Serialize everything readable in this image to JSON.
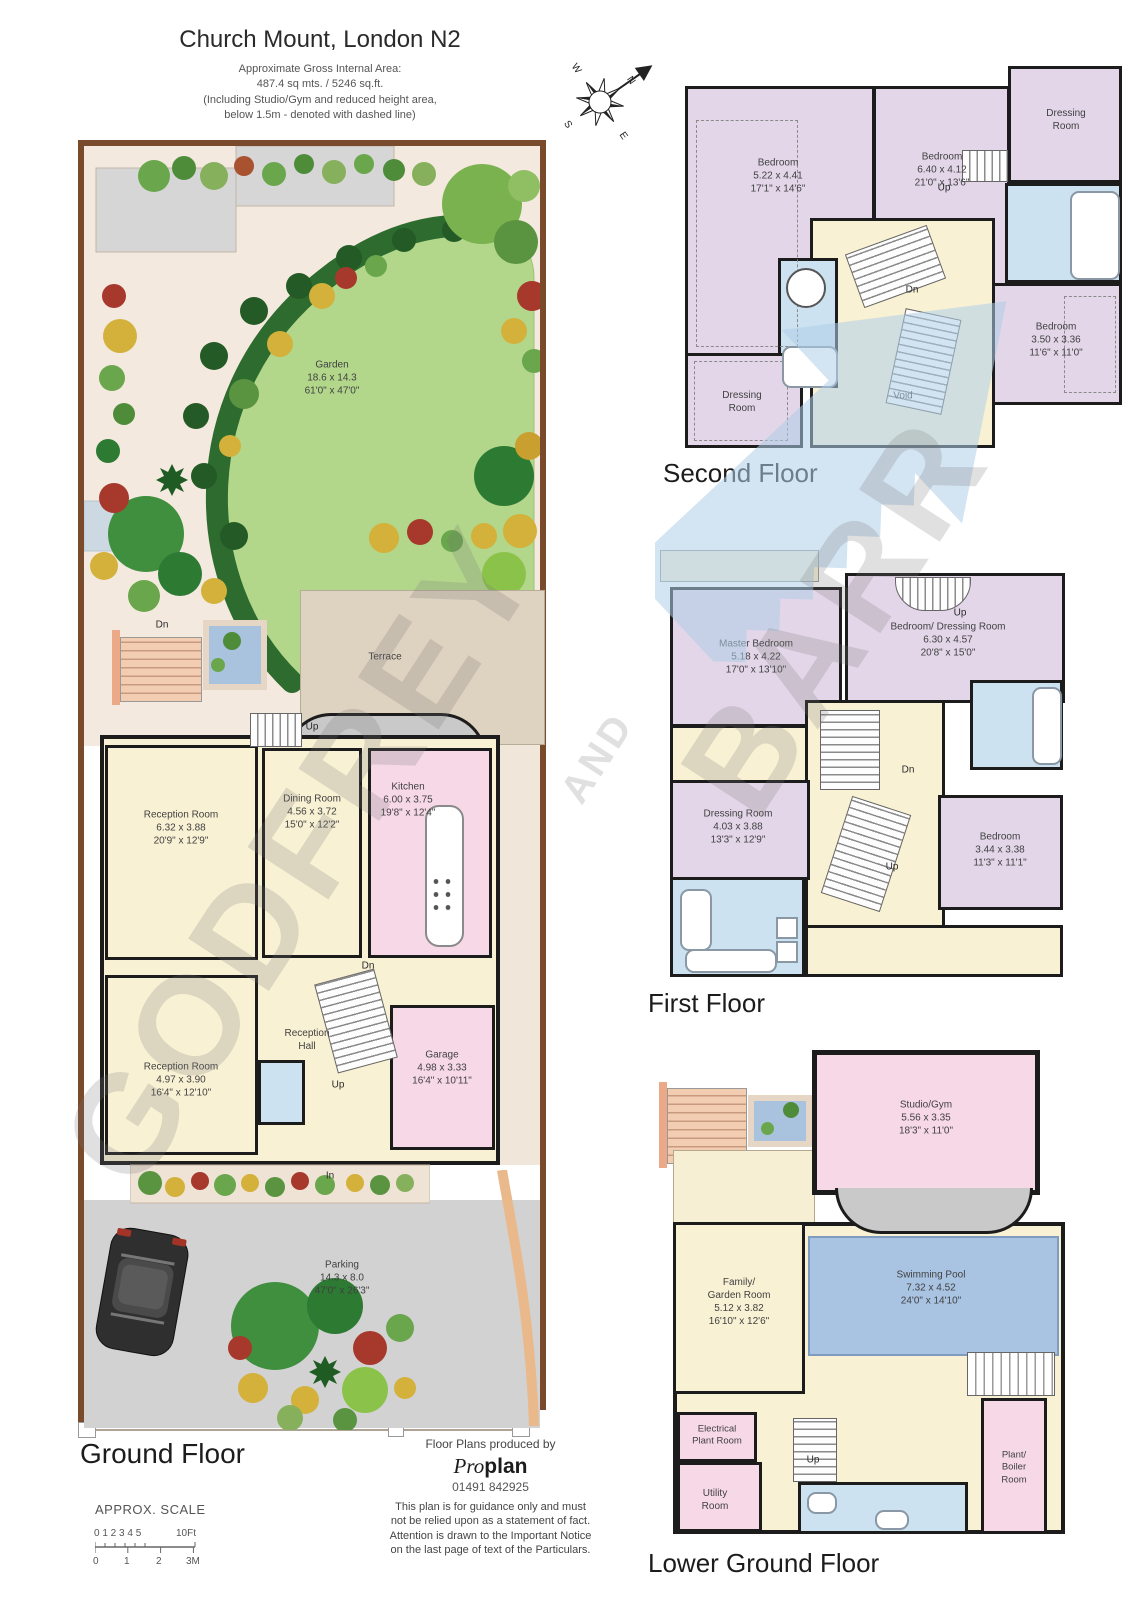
{
  "header": {
    "title": "Church Mount, London N2",
    "subtitle_lines": [
      "Approximate Gross Internal Area:",
      "487.4 sq mts. / 5246 sq.ft.",
      "(Including Studio/Gym and reduced height area,",
      "below 1.5m - denoted with dashed line)"
    ]
  },
  "compass": {
    "n": "N",
    "e": "E",
    "s": "S",
    "w": "W"
  },
  "ann": {
    "up": "Up",
    "dn": "Dn",
    "in": "In"
  },
  "watermark": {
    "word1": "GODFREY",
    "word2": "AND",
    "word3": "BARR"
  },
  "floors": {
    "ground": {
      "label": "Ground Floor",
      "garden": {
        "lines": [
          "Garden",
          "18.6 x 14.3",
          "61'0\" x 47'0\""
        ]
      },
      "terrace": {
        "lines": [
          "Terrace"
        ]
      },
      "reception1": {
        "lines": [
          "Reception Room",
          "6.32 x 3.88",
          "20'9\" x 12'9\""
        ]
      },
      "dining": {
        "lines": [
          "Dining Room",
          "4.56 x 3.72",
          "15'0\" x 12'2\""
        ]
      },
      "kitchen": {
        "lines": [
          "Kitchen",
          "6.00 x 3.75",
          "19'8\" x 12'4\""
        ]
      },
      "hall": {
        "lines": [
          "Reception",
          "Hall"
        ]
      },
      "reception2": {
        "lines": [
          "Reception Room",
          "4.97 x 3.90",
          "16'4\" x 12'10\""
        ]
      },
      "garage": {
        "lines": [
          "Garage",
          "4.98 x 3.33",
          "16'4\" x 10'11\""
        ]
      },
      "parking": {
        "lines": [
          "Parking",
          "14.3 x 8.0",
          "47'0\" x 26'3\""
        ]
      }
    },
    "second": {
      "label": "Second Floor",
      "bedroom1": {
        "lines": [
          "Bedroom",
          "5.22 x 4.41",
          "17'1\" x 14'6\""
        ]
      },
      "bedroom2": {
        "lines": [
          "Bedroom",
          "6.40 x 4.12",
          "21'0\" x 13'6\""
        ]
      },
      "dressing1": {
        "lines": [
          "Dressing",
          "Room"
        ]
      },
      "bedroom3": {
        "lines": [
          "Bedroom",
          "3.50 x 3.36",
          "11'6\" x 11'0\""
        ]
      },
      "dressing2": {
        "lines": [
          "Dressing",
          "Room"
        ]
      },
      "void_label": {
        "lines": [
          "Void"
        ]
      }
    },
    "first": {
      "label": "First Floor",
      "master": {
        "lines": [
          "Master Bedroom",
          "5.18 x 4.22",
          "17'0\" x 13'10\""
        ]
      },
      "beddress": {
        "lines": [
          "Bedroom/ Dressing Room",
          "6.30 x 4.57",
          "20'8\" x 15'0\""
        ]
      },
      "dressing": {
        "lines": [
          "Dressing Room",
          "4.03 x 3.88",
          "13'3\" x 12'9\""
        ]
      },
      "bedroom": {
        "lines": [
          "Bedroom",
          "3.44 x 3.38",
          "11'3\" x 11'1\""
        ]
      }
    },
    "lower": {
      "label": "Lower Ground Floor",
      "studio": {
        "lines": [
          "Studio/Gym",
          "5.56 x 3.35",
          "18'3\" x 11'0\""
        ]
      },
      "family": {
        "lines": [
          "Family/",
          "Garden Room",
          "5.12 x 3.82",
          "16'10\" x 12'6\""
        ]
      },
      "pool": {
        "lines": [
          "Swimming Pool",
          "7.32 x 4.52",
          "24'0\" x 14'10\""
        ]
      },
      "electrical": {
        "lines": [
          "Electrical",
          "Plant Room"
        ]
      },
      "utility": {
        "lines": [
          "Utility",
          "Room"
        ]
      },
      "boiler": {
        "lines": [
          "Plant/",
          "Boiler",
          "Room"
        ]
      }
    }
  },
  "footer": {
    "produced_by": "Floor Plans produced by",
    "brand_pro": "Pro",
    "brand_plan": "plan",
    "phone": "01491 842925",
    "disclaimer_lines": [
      "This plan is for guidance only and must",
      "not be relied upon as a statement of fact.",
      "Attention is drawn to the Important Notice",
      "on the last page of text of the Particulars."
    ]
  },
  "scale": {
    "label": "APPROX. SCALE",
    "ft_numbers": "0 1 2 3 4 5",
    "ft_end": "10Ft",
    "m0": "0",
    "m1": "1",
    "m2": "2",
    "m3": "3M"
  },
  "colors": {
    "wall": "#1c1c1c",
    "bedroom_lavender": "#e2d6e8",
    "living_cream": "#f9f1d4",
    "utility_pink": "#f7d8e7",
    "bathroom_blue": "#cde2f0",
    "pool_blue": "#a9c3e2",
    "lawn_green": "#b2d78b",
    "hedge_green": "#2d6b2e",
    "terrace_tan": "#ded2c0",
    "paving_grey": "#d2d2d2",
    "boundary_brown": "#7a4a2c",
    "steps_salmon": "#f3cdb2",
    "watermark_blue": "#aecde7",
    "watermark_grey": "#777777"
  }
}
